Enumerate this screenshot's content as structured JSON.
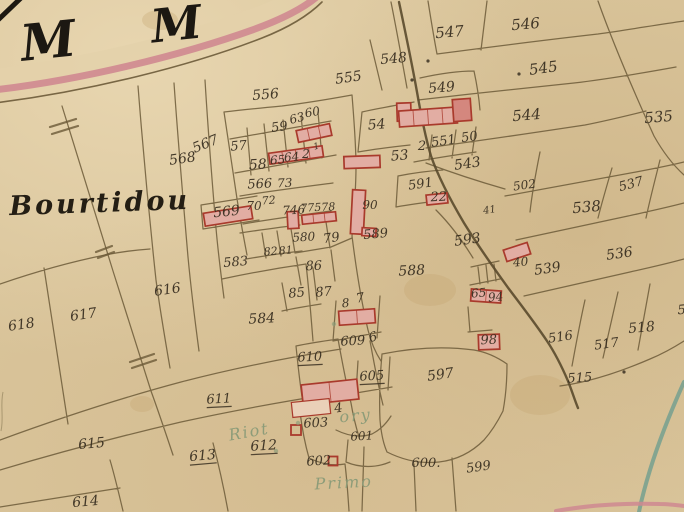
{
  "map": {
    "type": "historical-cadastral-map",
    "region_name": "Bourtidou",
    "place_labels": [
      {
        "t": "M",
        "x": 50,
        "y": 58,
        "s": 50,
        "r": -6,
        "cls": "letter"
      },
      {
        "t": "M",
        "x": 178,
        "y": 40,
        "s": 46,
        "r": -6,
        "cls": "letter"
      },
      {
        "t": "Bourtidou",
        "x": 100,
        "y": 212,
        "s": 27,
        "r": -2,
        "cls": "name"
      },
      {
        "t": "Riot",
        "x": 250,
        "y": 437,
        "s": 16,
        "r": -10,
        "cls": "green"
      },
      {
        "t": "ory",
        "x": 356,
        "y": 421,
        "s": 16,
        "r": -5,
        "cls": "green"
      },
      {
        "t": "Primo",
        "x": 344,
        "y": 488,
        "s": 16,
        "r": -3,
        "cls": "green"
      }
    ],
    "parcel_labels": [
      {
        "n": "556",
        "x": 266,
        "y": 99,
        "s": 14,
        "r": -5
      },
      {
        "n": "568",
        "x": 183,
        "y": 163,
        "s": 14,
        "r": -8
      },
      {
        "n": "567",
        "x": 207,
        "y": 148,
        "s": 14,
        "r": -22
      },
      {
        "n": "57",
        "x": 239,
        "y": 150,
        "s": 13,
        "r": -5
      },
      {
        "n": "59",
        "x": 280,
        "y": 131,
        "s": 13,
        "r": -8
      },
      {
        "n": "63",
        "x": 298,
        "y": 122,
        "s": 12,
        "r": -15
      },
      {
        "n": "60",
        "x": 313,
        "y": 116,
        "s": 12,
        "r": -10
      },
      {
        "n": "58",
        "x": 258,
        "y": 169,
        "s": 14,
        "r": -3
      },
      {
        "n": "65",
        "x": 278,
        "y": 164,
        "s": 12,
        "r": -5
      },
      {
        "n": "64",
        "x": 292,
        "y": 161,
        "s": 12,
        "r": -5
      },
      {
        "n": "2",
        "x": 306,
        "y": 158,
        "s": 12,
        "r": 0
      },
      {
        "n": "1",
        "x": 317,
        "y": 149,
        "s": 9,
        "r": -15
      },
      {
        "n": "566",
        "x": 260,
        "y": 188,
        "s": 13,
        "r": -3
      },
      {
        "n": "73",
        "x": 285,
        "y": 187,
        "s": 12,
        "r": -3
      },
      {
        "n": "569",
        "x": 227,
        "y": 216,
        "s": 14,
        "r": -6
      },
      {
        "n": "70",
        "x": 254,
        "y": 210,
        "s": 12,
        "r": 0
      },
      {
        "n": "72",
        "x": 269,
        "y": 204,
        "s": 11,
        "r": -5
      },
      {
        "n": "746",
        "x": 294,
        "y": 214,
        "s": 12,
        "r": -3
      },
      {
        "n": "77578",
        "x": 318,
        "y": 211,
        "s": 11,
        "r": -3
      },
      {
        "n": "90",
        "x": 370,
        "y": 209,
        "s": 12,
        "r": 0
      },
      {
        "n": "589",
        "x": 376,
        "y": 238,
        "s": 13,
        "r": -5
      },
      {
        "n": "580",
        "x": 304,
        "y": 241,
        "s": 12,
        "r": -3
      },
      {
        "n": "79",
        "x": 332,
        "y": 242,
        "s": 13,
        "r": -8
      },
      {
        "n": "82",
        "x": 271,
        "y": 255,
        "s": 11,
        "r": -5
      },
      {
        "n": "81",
        "x": 286,
        "y": 254,
        "s": 11,
        "r": -5
      },
      {
        "n": "583",
        "x": 236,
        "y": 266,
        "s": 13,
        "r": -5
      },
      {
        "n": "86",
        "x": 314,
        "y": 270,
        "s": 13,
        "r": -3
      },
      {
        "n": "85",
        "x": 297,
        "y": 297,
        "s": 13,
        "r": -5
      },
      {
        "n": "87",
        "x": 324,
        "y": 296,
        "s": 13,
        "r": -5
      },
      {
        "n": "584",
        "x": 262,
        "y": 323,
        "s": 14,
        "r": -3
      },
      {
        "n": "8",
        "x": 346,
        "y": 307,
        "s": 12,
        "r": -5
      },
      {
        "n": "7",
        "x": 361,
        "y": 302,
        "s": 13,
        "r": -10
      },
      {
        "n": "609",
        "x": 353,
        "y": 345,
        "s": 13,
        "r": -3
      },
      {
        "n": "6",
        "x": 374,
        "y": 341,
        "s": 13,
        "r": -15
      },
      {
        "n": "610",
        "x": 310,
        "y": 361,
        "s": 13,
        "r": -3,
        "u": true
      },
      {
        "n": "605",
        "x": 372,
        "y": 380,
        "s": 13,
        "r": -3,
        "u": true
      },
      {
        "n": "4",
        "x": 339,
        "y": 412,
        "s": 13,
        "r": -8
      },
      {
        "n": "603",
        "x": 316,
        "y": 427,
        "s": 13,
        "r": -3
      },
      {
        "n": "601",
        "x": 362,
        "y": 440,
        "s": 12,
        "r": -3
      },
      {
        "n": "602",
        "x": 319,
        "y": 465,
        "s": 13,
        "r": -3
      },
      {
        "n": "600.",
        "x": 426,
        "y": 467,
        "s": 13,
        "r": 0
      },
      {
        "n": "599",
        "x": 479,
        "y": 471,
        "s": 13,
        "r": -8
      },
      {
        "n": "597",
        "x": 441,
        "y": 379,
        "s": 14,
        "r": -8
      },
      {
        "n": "611",
        "x": 219,
        "y": 403,
        "s": 13,
        "r": -3,
        "u": true
      },
      {
        "n": "615",
        "x": 92,
        "y": 448,
        "s": 14,
        "r": -5
      },
      {
        "n": "613",
        "x": 203,
        "y": 460,
        "s": 14,
        "r": -5,
        "u": true
      },
      {
        "n": "612",
        "x": 264,
        "y": 450,
        "s": 14,
        "r": -3,
        "u": true
      },
      {
        "n": "614",
        "x": 86,
        "y": 506,
        "s": 14,
        "r": -5
      },
      {
        "n": "616",
        "x": 168,
        "y": 294,
        "s": 14,
        "r": -8
      },
      {
        "n": "617",
        "x": 84,
        "y": 319,
        "s": 14,
        "r": -8
      },
      {
        "n": "618",
        "x": 22,
        "y": 329,
        "s": 14,
        "r": -8
      },
      {
        "n": "588",
        "x": 412,
        "y": 275,
        "s": 14,
        "r": -3
      },
      {
        "n": "593",
        "x": 468,
        "y": 244,
        "s": 14,
        "r": -8
      },
      {
        "n": "591",
        "x": 421,
        "y": 188,
        "s": 13,
        "r": -8
      },
      {
        "n": "22",
        "x": 439,
        "y": 201,
        "s": 13,
        "r": -3
      },
      {
        "n": "41",
        "x": 490,
        "y": 213,
        "s": 10,
        "r": -8
      },
      {
        "n": "53",
        "x": 400,
        "y": 160,
        "s": 14,
        "r": -5
      },
      {
        "n": "2",
        "x": 422,
        "y": 150,
        "s": 13,
        "r": 0
      },
      {
        "n": "551",
        "x": 444,
        "y": 145,
        "s": 13,
        "r": -8
      },
      {
        "n": "50",
        "x": 470,
        "y": 141,
        "s": 13,
        "r": -8
      },
      {
        "n": "54",
        "x": 377,
        "y": 129,
        "s": 14,
        "r": -5
      },
      {
        "n": "543",
        "x": 468,
        "y": 168,
        "s": 14,
        "r": -8
      },
      {
        "n": "549",
        "x": 442,
        "y": 92,
        "s": 14,
        "r": -5
      },
      {
        "n": "548",
        "x": 394,
        "y": 63,
        "s": 14,
        "r": -5
      },
      {
        "n": "555",
        "x": 349,
        "y": 82,
        "s": 14,
        "r": -8
      },
      {
        "n": "547",
        "x": 450,
        "y": 37,
        "s": 15,
        "r": -5
      },
      {
        "n": "546",
        "x": 526,
        "y": 29,
        "s": 15,
        "r": -5
      },
      {
        "n": "545",
        "x": 544,
        "y": 73,
        "s": 15,
        "r": -8
      },
      {
        "n": "544",
        "x": 527,
        "y": 120,
        "s": 15,
        "r": -5
      },
      {
        "n": "535",
        "x": 659,
        "y": 122,
        "s": 15,
        "r": -5
      },
      {
        "n": "502",
        "x": 525,
        "y": 189,
        "s": 12,
        "r": -8
      },
      {
        "n": "537",
        "x": 632,
        "y": 188,
        "s": 13,
        "r": -15
      },
      {
        "n": "538",
        "x": 587,
        "y": 212,
        "s": 15,
        "r": -5
      },
      {
        "n": "536",
        "x": 620,
        "y": 258,
        "s": 14,
        "r": -8
      },
      {
        "n": "539",
        "x": 548,
        "y": 273,
        "s": 14,
        "r": -8
      },
      {
        "n": "40",
        "x": 521,
        "y": 266,
        "s": 12,
        "r": -5
      },
      {
        "n": "65",
        "x": 479,
        "y": 297,
        "s": 12,
        "r": -5
      },
      {
        "n": "94",
        "x": 496,
        "y": 301,
        "s": 12,
        "r": -5
      },
      {
        "n": "98",
        "x": 489,
        "y": 344,
        "s": 13,
        "r": -3
      },
      {
        "n": "516",
        "x": 561,
        "y": 341,
        "s": 13,
        "r": -8
      },
      {
        "n": "517",
        "x": 607,
        "y": 348,
        "s": 13,
        "r": -8
      },
      {
        "n": "518",
        "x": 642,
        "y": 332,
        "s": 14,
        "r": -5
      },
      {
        "n": "515",
        "x": 580,
        "y": 382,
        "s": 13,
        "r": -3
      },
      {
        "n": "5",
        "x": 682,
        "y": 314,
        "s": 13,
        "r": -5
      }
    ],
    "buildings": [
      {
        "x": 314,
        "y": 133,
        "w": 34,
        "h": 12,
        "r": -12,
        "v": "p",
        "cells": 3
      },
      {
        "x": 296,
        "y": 155,
        "w": 54,
        "h": 11,
        "r": -8,
        "v": "p",
        "cells": 4
      },
      {
        "x": 404,
        "y": 112,
        "w": 14,
        "h": 18,
        "r": -2,
        "v": "p",
        "cells": 1
      },
      {
        "x": 428,
        "y": 117,
        "w": 58,
        "h": 16,
        "r": -4,
        "v": "p",
        "cells": 4
      },
      {
        "x": 462,
        "y": 110,
        "w": 18,
        "h": 22,
        "r": -4,
        "v": "d",
        "cells": 1
      },
      {
        "x": 362,
        "y": 162,
        "w": 36,
        "h": 12,
        "r": -2,
        "v": "p",
        "cells": 1
      },
      {
        "x": 228,
        "y": 216,
        "w": 48,
        "h": 13,
        "r": -9,
        "v": "p",
        "cells": 1
      },
      {
        "x": 293,
        "y": 220,
        "w": 11,
        "h": 17,
        "r": -3,
        "v": "p",
        "cells": 1
      },
      {
        "x": 319,
        "y": 218,
        "w": 34,
        "h": 9,
        "r": -6,
        "v": "p",
        "cells": 3
      },
      {
        "x": 358,
        "y": 212,
        "w": 13,
        "h": 44,
        "r": 3,
        "v": "p",
        "cells": 1
      },
      {
        "x": 369,
        "y": 232,
        "w": 14,
        "h": 8,
        "r": 3,
        "v": "p",
        "cells": 1
      },
      {
        "x": 437,
        "y": 199,
        "w": 21,
        "h": 10,
        "r": -6,
        "v": "p",
        "cells": 1
      },
      {
        "x": 517,
        "y": 252,
        "w": 25,
        "h": 12,
        "r": -18,
        "v": "p",
        "cells": 1
      },
      {
        "x": 486,
        "y": 296,
        "w": 30,
        "h": 12,
        "r": 4,
        "v": "p",
        "cells": 2
      },
      {
        "x": 489,
        "y": 342,
        "w": 21,
        "h": 15,
        "r": -2,
        "v": "p",
        "cells": 1
      },
      {
        "x": 357,
        "y": 317,
        "w": 36,
        "h": 14,
        "r": -4,
        "v": "p",
        "cells": 2
      },
      {
        "x": 330,
        "y": 392,
        "w": 56,
        "h": 20,
        "r": -6,
        "v": "p",
        "cells": 2
      },
      {
        "x": 311,
        "y": 408,
        "w": 38,
        "h": 15,
        "r": -6,
        "v": "l",
        "cells": 1
      },
      {
        "x": 296,
        "y": 430,
        "w": 10,
        "h": 10,
        "r": 0,
        "v": "o",
        "cells": 1
      },
      {
        "x": 333,
        "y": 461,
        "w": 9,
        "h": 9,
        "r": 0,
        "v": "o",
        "cells": 1
      }
    ],
    "dots": [
      [
        428,
        61
      ],
      [
        412,
        80
      ],
      [
        519,
        74
      ],
      [
        624,
        372
      ]
    ],
    "green_dots": [
      [
        298,
        423
      ],
      [
        276,
        451
      ],
      [
        334,
        324
      ]
    ],
    "ticks": [
      [
        50,
        127,
        76,
        119
      ],
      [
        52,
        134,
        78,
        126
      ],
      [
        96,
        252,
        112,
        246
      ],
      [
        98,
        258,
        114,
        252
      ],
      [
        130,
        362,
        154,
        354
      ],
      [
        132,
        368,
        156,
        360
      ]
    ],
    "stains": [
      [
        142,
        404,
        12,
        8
      ],
      [
        540,
        395,
        30,
        20
      ],
      [
        430,
        290,
        26,
        16
      ],
      [
        160,
        20,
        18,
        10
      ]
    ],
    "colors": {
      "parchment": "#d9c49a",
      "ink": "#3a3022",
      "boundary": "#6c5a38",
      "road_dark": "#5a4a2c",
      "road_pink": "#cf8890",
      "road_surface": "#e4d1aa",
      "building_fill": "#e2ada3",
      "building_fill_dark": "#d4877e",
      "building_fill_light": "#ead0b8",
      "building_stroke": "#a93a2c",
      "label_green": "#8a9b78",
      "stream": "#6f9e8e",
      "letter_ink": "#1c1812",
      "stain": "#c4a571"
    }
  }
}
